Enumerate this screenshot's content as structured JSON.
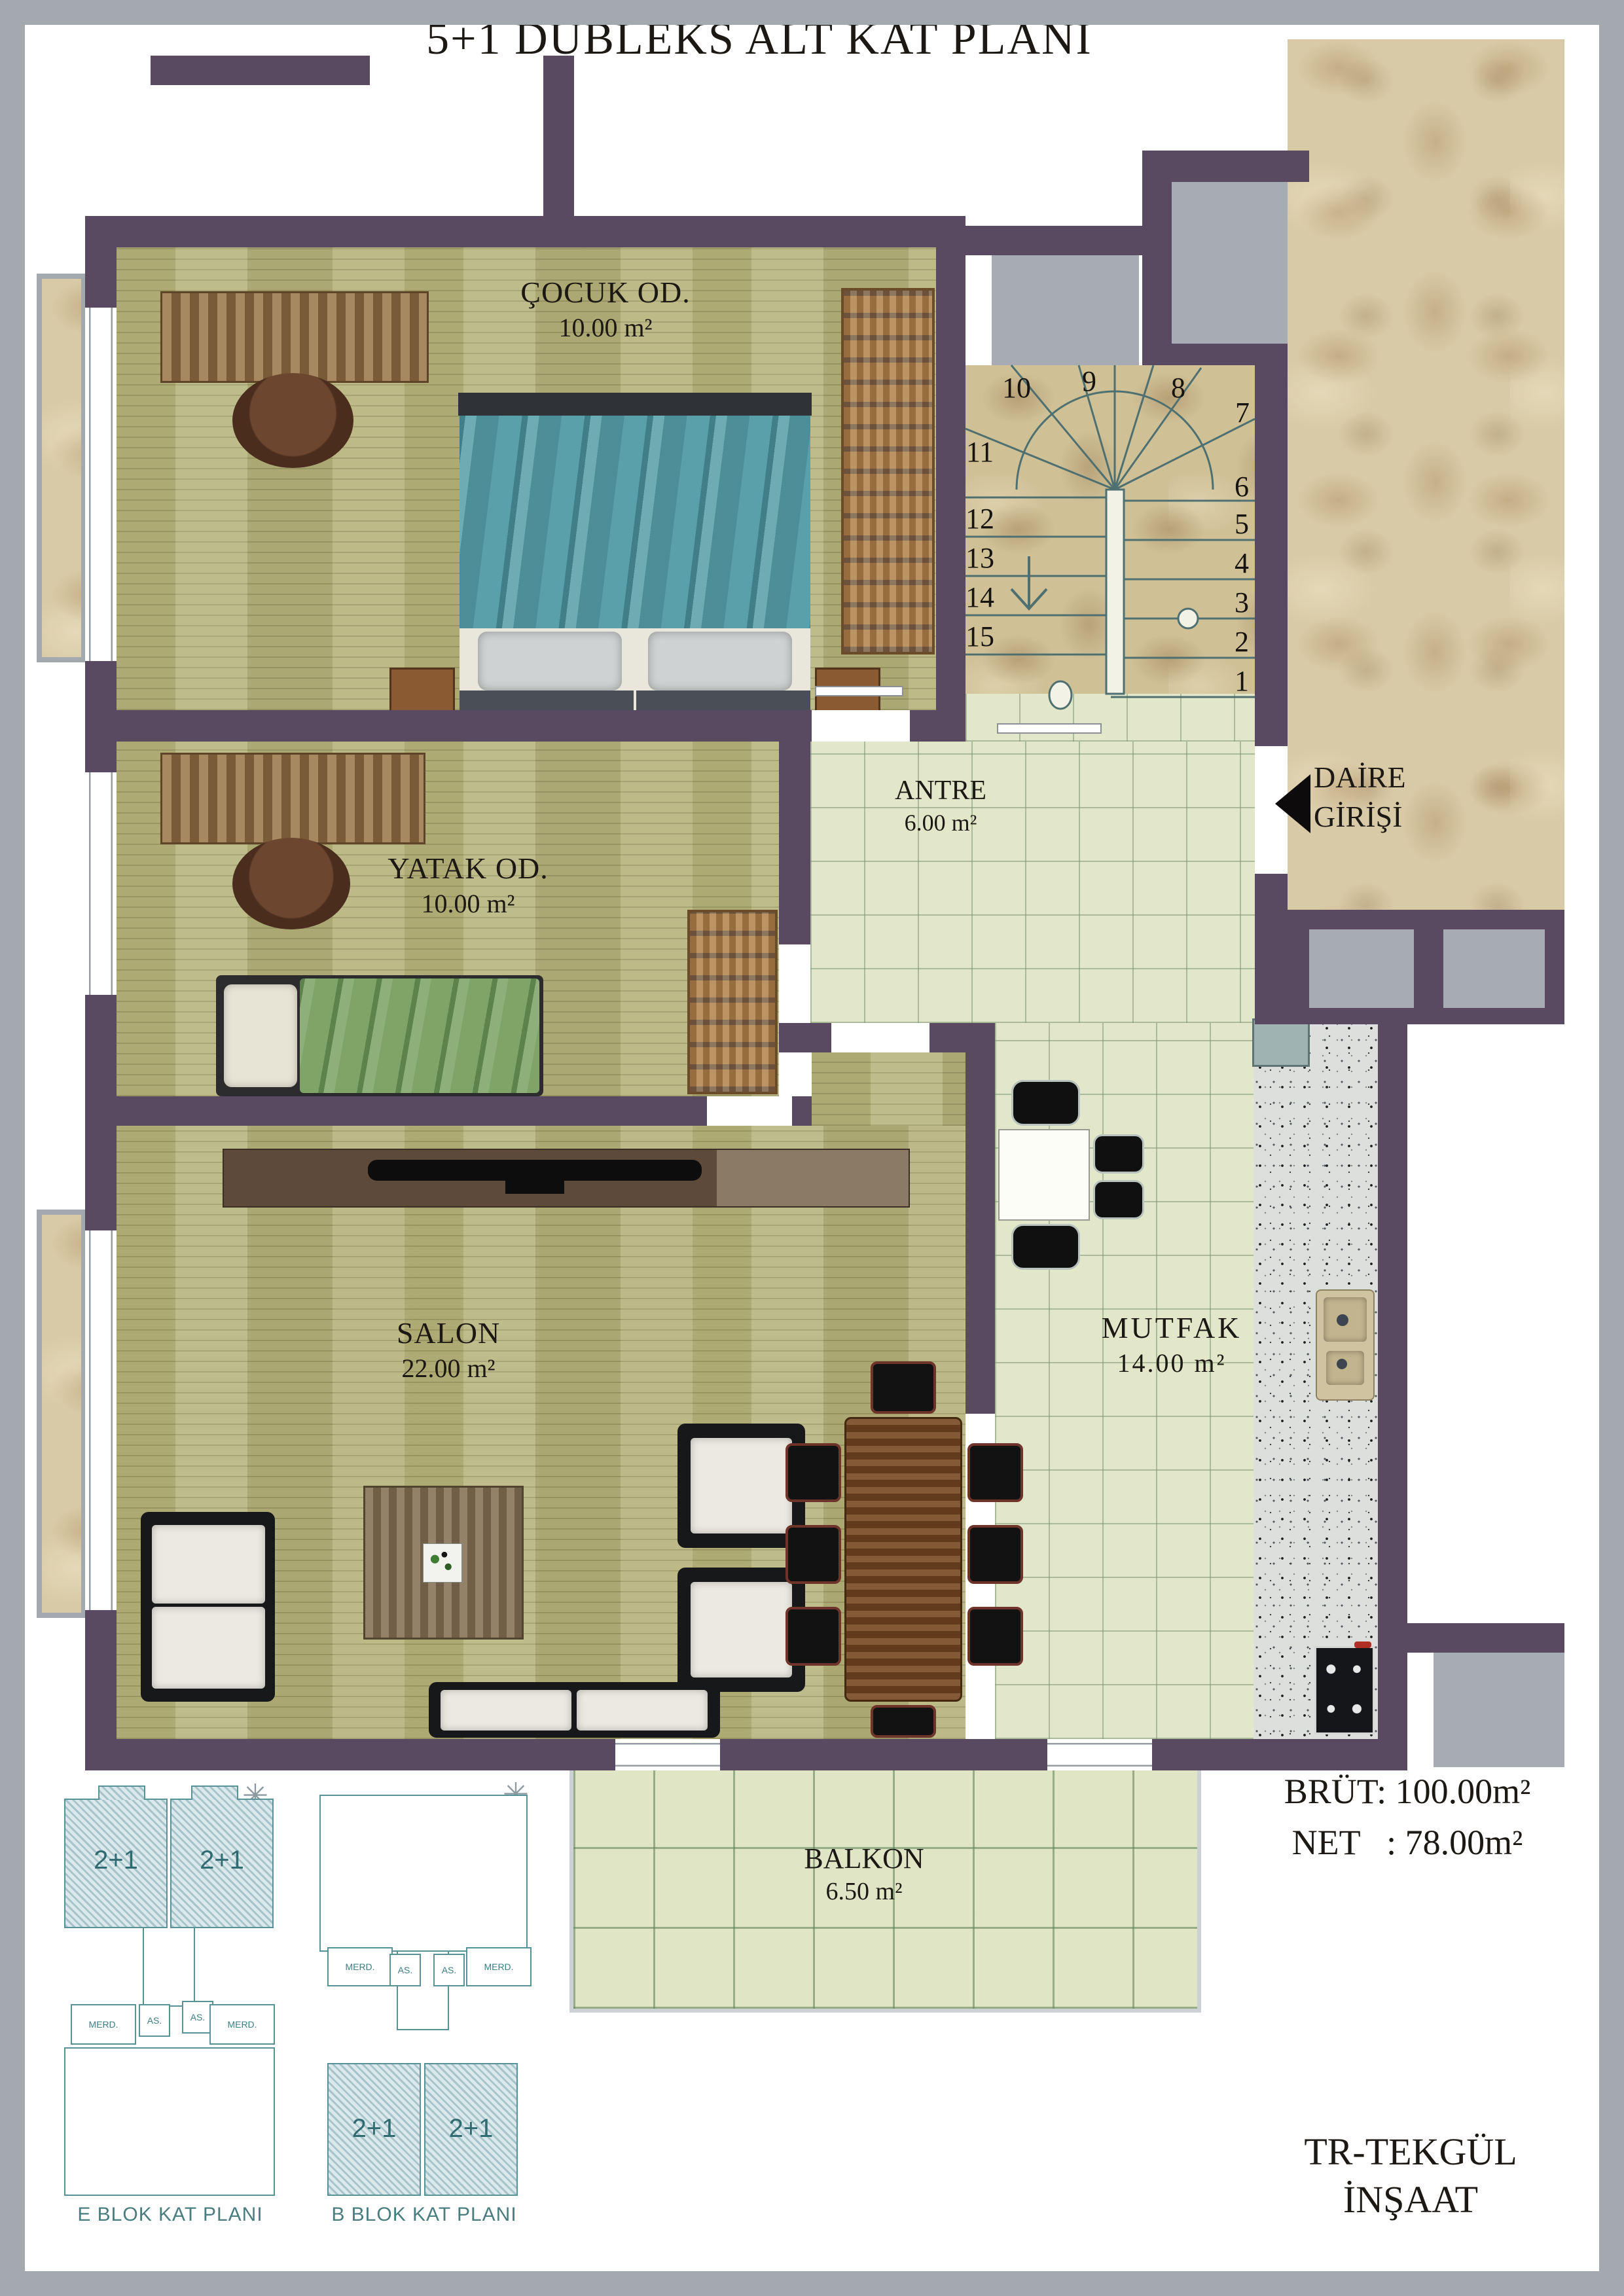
{
  "title": "5+1 DUBLEKS ALT KAT PLANI",
  "rooms": {
    "cocuk": {
      "name": "ÇOCUK OD.",
      "area": "10.00 m²"
    },
    "yatak": {
      "name": "YATAK OD.",
      "area": "10.00 m²"
    },
    "salon": {
      "name": "SALON",
      "area": "22.00 m²"
    },
    "mutfak": {
      "name": "MUTFAK",
      "area": "14.00 m²"
    },
    "antre": {
      "name": "ANTRE",
      "area": "6.00 m²"
    },
    "balkon": {
      "name": "BALKON",
      "area": "6.50 m²"
    }
  },
  "entry": {
    "line1": "DAİRE",
    "line2": "GİRİŞİ"
  },
  "stairs": {
    "numbers": [
      "1",
      "2",
      "3",
      "4",
      "5",
      "6",
      "7",
      "8",
      "9",
      "10",
      "11",
      "12",
      "13",
      "14",
      "15"
    ]
  },
  "areas": {
    "brut": "BRÜT: 100.00m²",
    "net": "NET   : 78.00m²"
  },
  "company": {
    "line1": "TR-TEKGÜL",
    "line2": "İNŞAAT"
  },
  "block_plans": {
    "e": {
      "label": "E BLOK KAT PLANI",
      "unit1": "2+1",
      "unit2": "2+1",
      "merd_left": "MERD.",
      "as_left": "AS.",
      "as_right": "AS.",
      "merd_right": "MERD."
    },
    "b": {
      "label": "B BLOK KAT PLANI",
      "unit1": "2+1",
      "unit2": "2+1",
      "merd_left": "MERD.",
      "as_left": "AS.",
      "as_right": "AS.",
      "merd_right": "MERD."
    }
  },
  "colors": {
    "wall": "#594a61",
    "wood": "#b8b57f",
    "tile": "#e3e7ca",
    "marble": "#d8caa6",
    "gray": "#a7abb4",
    "teal_outline": "#569296",
    "accent_text": "#3f7e82"
  }
}
